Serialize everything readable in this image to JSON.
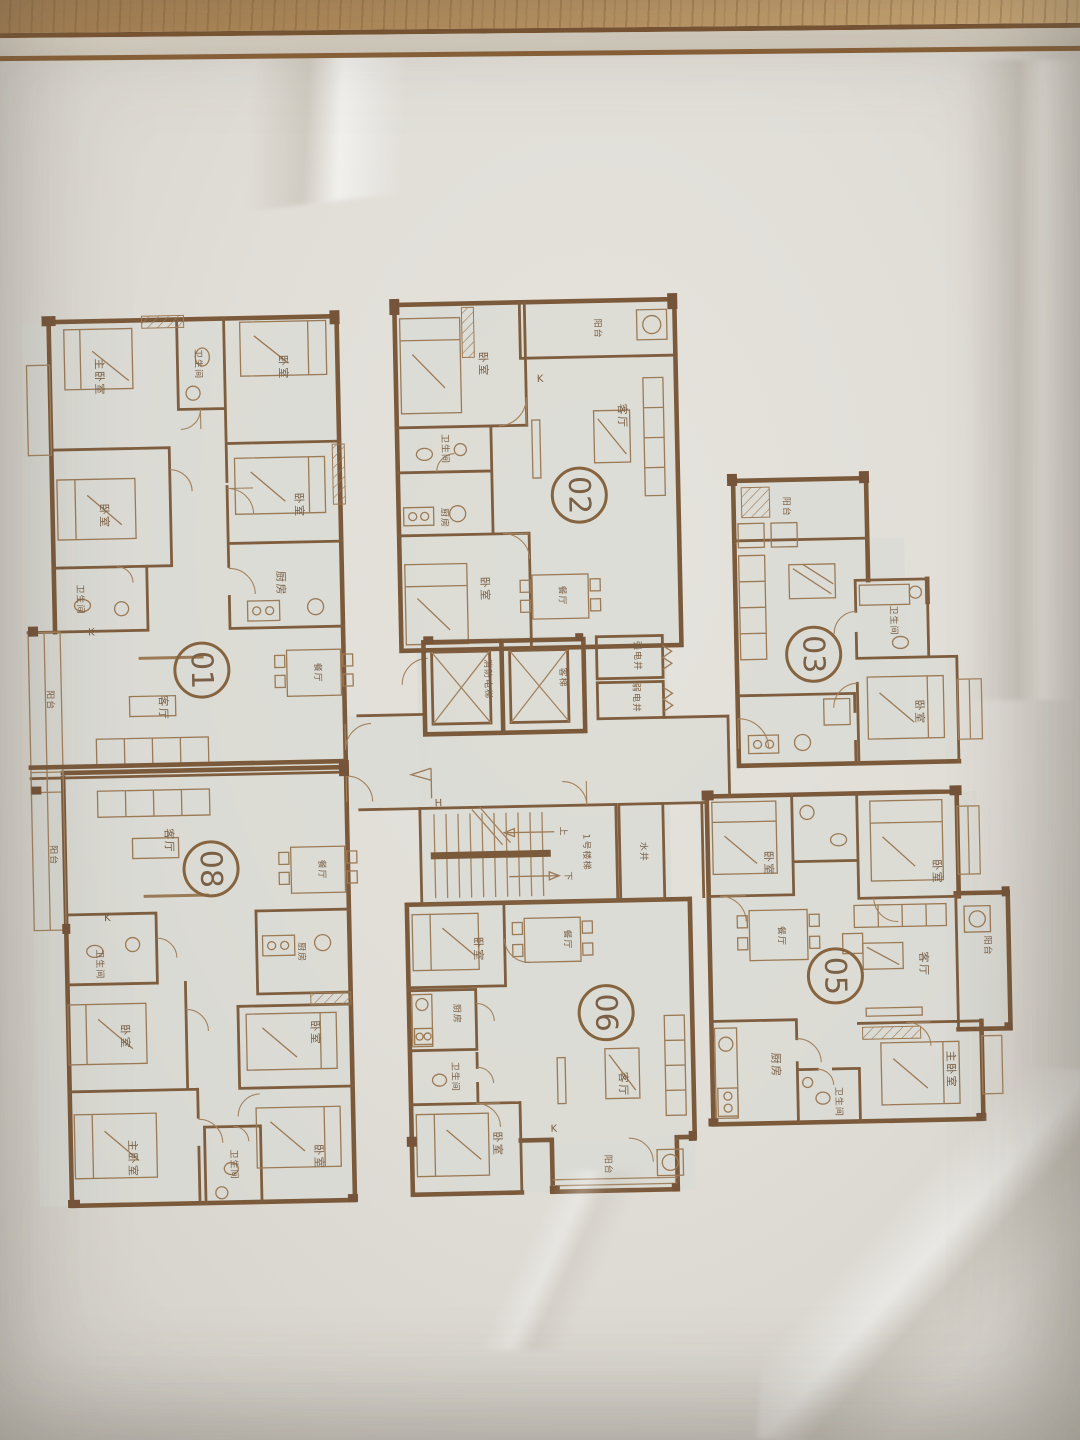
{
  "scene": {
    "paper_color": "#e2dfd9",
    "desk_wood_color": "#b78e5a",
    "plan_line_color": "#7b5a3b",
    "label_color": "#7a6046"
  },
  "units": [
    {
      "number": "01",
      "rooms": [
        "主卧室",
        "卫生间",
        "卧室",
        "卧室",
        "卧室",
        "厨房",
        "卫生间",
        "客厅",
        "餐厅",
        "阳台"
      ]
    },
    {
      "number": "02",
      "rooms": [
        "卧室",
        "阳台",
        "客厅",
        "卫生间",
        "厨房",
        "卧室",
        "餐厅"
      ]
    },
    {
      "number": "03",
      "rooms": [
        "阳台",
        "卫生间",
        "卧室"
      ]
    },
    {
      "number": "05",
      "rooms": [
        "卧室",
        "卧室",
        "餐厅",
        "客厅",
        "阳台",
        "厨房",
        "卫生间",
        "主卧室"
      ]
    },
    {
      "number": "06",
      "rooms": [
        "卧室",
        "餐厅",
        "厨房",
        "卫生间",
        "卧室",
        "客厅",
        "阳台"
      ]
    },
    {
      "number": "08",
      "rooms": [
        "客厅",
        "餐厅",
        "阳台",
        "卫生间",
        "卧室",
        "厨房",
        "卧室",
        "主卧室",
        "卫生间",
        "卧室"
      ]
    }
  ],
  "core": {
    "fire_elevator": "消防电梯",
    "passenger_elevator": "客梯",
    "strong_power_shaft": "强电井",
    "weak_power_shaft": "弱电井",
    "stair_name": "1号楼梯",
    "stair_up": "上",
    "stair_down": "下",
    "water_shaft": "水井"
  },
  "annotations": {
    "k_marks": [
      "K",
      "K",
      "K",
      "K"
    ],
    "h_mark": "H"
  }
}
